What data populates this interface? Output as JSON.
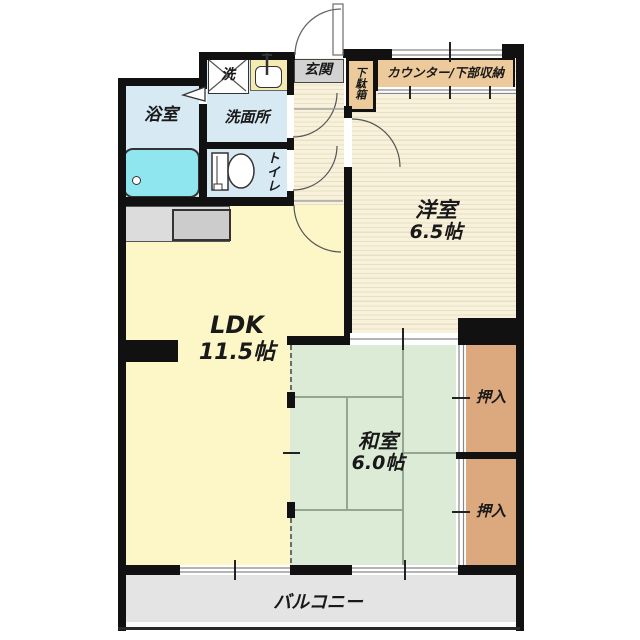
{
  "rooms": {
    "bathroom": {
      "name": "浴室"
    },
    "washroom": {
      "name": "洗面所"
    },
    "washer": {
      "name": "洗"
    },
    "toilet": {
      "name": "トイレ"
    },
    "entrance": {
      "name": "玄関"
    },
    "shoe_cabinet": {
      "name": "下駄箱"
    },
    "counter": {
      "name": "カウンター/下部収納"
    },
    "western_room": {
      "name": "洋室",
      "size": "6.5帖"
    },
    "ldk": {
      "name": "LDK",
      "size": "11.5帖"
    },
    "japanese_room": {
      "name": "和室",
      "size": "6.0帖"
    },
    "closet_upper": {
      "name": "押入"
    },
    "closet_lower": {
      "name": "押入"
    },
    "balcony": {
      "name": "バルコニー"
    }
  },
  "colors": {
    "wall": "#111111",
    "water_rooms": "#d7eaf4",
    "bathtub": "#8fe6ee",
    "ldk_floor": "#fdf7c8",
    "wood_floor": "#f8f2dc",
    "wood_stripe": "#e9dfc2",
    "tatami": "#dcebd5",
    "tatami_line": "#93a693",
    "closet": "#dca87e",
    "counter": "#ecca9b",
    "entrance_tile": "#d2d2d2",
    "balcony_floor": "#e4e4e4",
    "sink_unit": "#f5eab2"
  }
}
